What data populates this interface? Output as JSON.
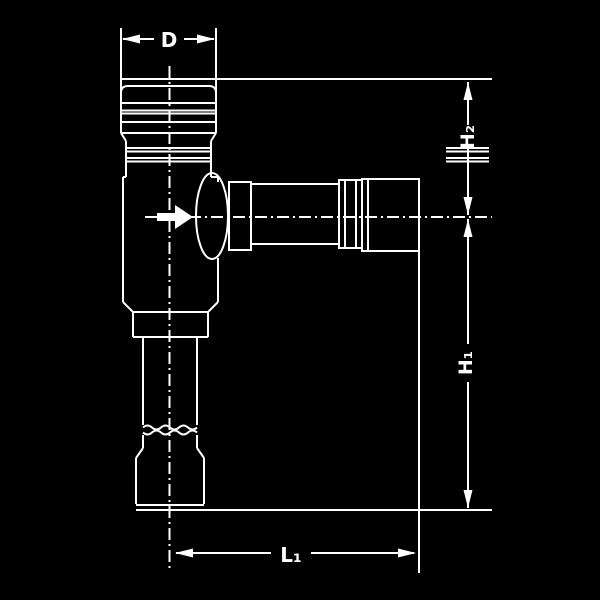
{
  "page": {
    "background_color": "#000000",
    "line_color": "#ffffff"
  },
  "drawing": {
    "labels": {
      "d": "D",
      "h2": "H₂",
      "h1": "H₁",
      "l1": "L₁"
    }
  }
}
